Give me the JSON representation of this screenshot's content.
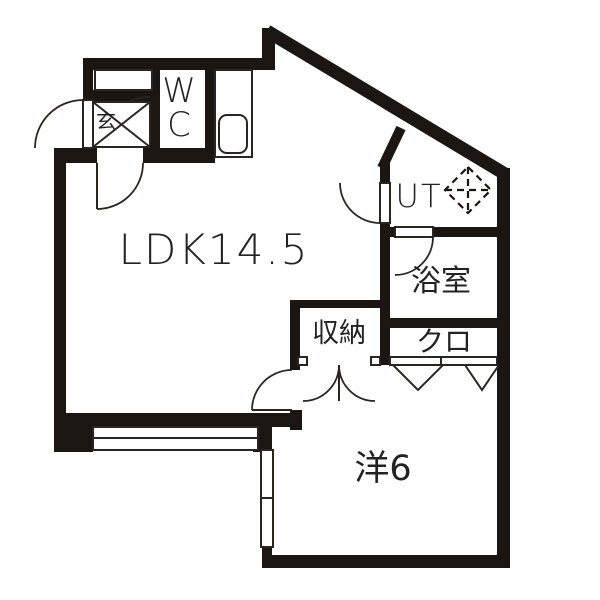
{
  "floorplan": {
    "title": "1LDK apartment floor plan",
    "rooms": {
      "ldk": {
        "label": "LDK14.5"
      },
      "genkan": {
        "label": "玄"
      },
      "wc": {
        "lines": [
          "W",
          "C"
        ]
      },
      "ut": {
        "label": "UT"
      },
      "bathroom": {
        "label": "浴室"
      },
      "closet": {
        "label": "クロ"
      },
      "storage": {
        "label": "収納"
      },
      "western_room": {
        "label": "洋6"
      }
    },
    "icons": {
      "washer_icon": "dashed-diamond",
      "toilet_sink_icon": "rounded-rect-basin"
    },
    "colors": {
      "wall": "#1b1611",
      "line": "#2a2520",
      "text": "#222222",
      "background": "#ffffff"
    }
  }
}
